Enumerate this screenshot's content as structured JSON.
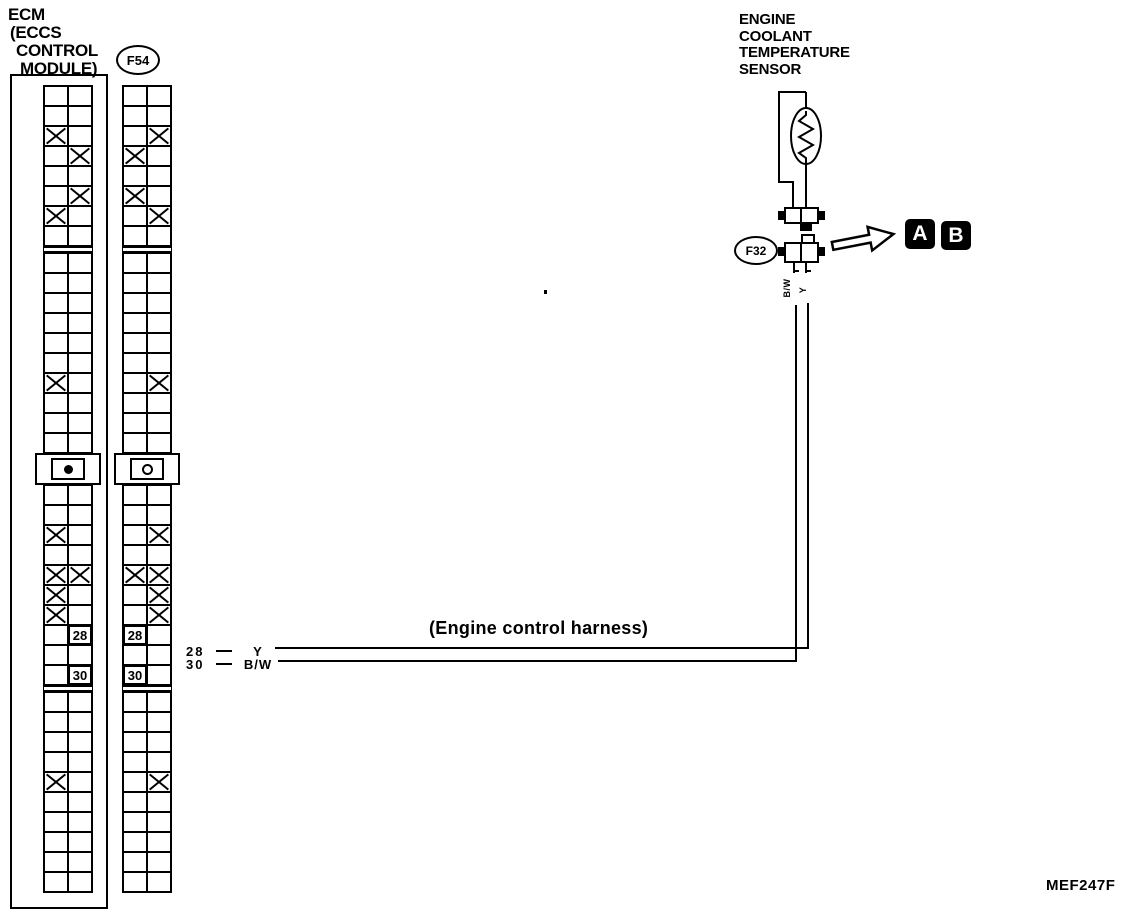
{
  "figure": {
    "code": "MEF247F"
  },
  "harness_note": "(Engine control harness)",
  "ecm": {
    "title_lines": [
      "ECM",
      "(ECCS",
      "CONTROL",
      "MODULE)"
    ]
  },
  "sensor": {
    "title_lines": [
      "ENGINE",
      "COOLANT",
      "TEMPERATURE",
      "SENSOR"
    ]
  },
  "connector_labels": {
    "f54": "F54",
    "f32": "F32"
  },
  "callouts": {
    "a": "A",
    "b": "B"
  },
  "wires": [
    {
      "pin": "28",
      "color": "Y"
    },
    {
      "pin": "30",
      "color": "B/W"
    }
  ],
  "connector_pin_labels": {
    "left": "B/W",
    "right": "Y"
  },
  "ecm_grid": {
    "bolt": "filled",
    "rows": [
      [
        "",
        ""
      ],
      [
        "",
        ""
      ],
      [
        "x",
        ""
      ],
      [
        "",
        "x"
      ],
      [
        "",
        ""
      ],
      [
        "",
        "x"
      ],
      [
        "x",
        ""
      ],
      [
        "",
        ""
      ],
      "sep",
      [
        "",
        ""
      ],
      [
        "",
        ""
      ],
      [
        "",
        ""
      ],
      [
        "",
        ""
      ],
      [
        "",
        ""
      ],
      [
        "",
        ""
      ],
      [
        "x",
        ""
      ],
      [
        "",
        ""
      ],
      [
        "",
        ""
      ],
      [
        "",
        ""
      ],
      "dot",
      [
        "",
        ""
      ],
      [
        "",
        ""
      ],
      [
        "x",
        ""
      ],
      [
        "",
        ""
      ],
      [
        "x",
        "x"
      ],
      [
        "x",
        ""
      ],
      [
        "x",
        ""
      ],
      [
        "",
        "28"
      ],
      [
        "",
        ""
      ],
      [
        "",
        "30"
      ],
      "sep",
      [
        "",
        ""
      ],
      [
        "",
        ""
      ],
      [
        "",
        ""
      ],
      [
        "",
        ""
      ],
      [
        "x",
        ""
      ],
      [
        "",
        ""
      ],
      [
        "",
        ""
      ],
      [
        "",
        ""
      ],
      [
        "",
        ""
      ],
      [
        "",
        ""
      ]
    ]
  },
  "f54_grid": {
    "bolt": "hollow",
    "rows": [
      [
        "",
        ""
      ],
      [
        "",
        ""
      ],
      [
        "",
        "x"
      ],
      [
        "x",
        ""
      ],
      [
        "",
        ""
      ],
      [
        "x",
        ""
      ],
      [
        "",
        "x"
      ],
      [
        "",
        ""
      ],
      "sep",
      [
        "",
        ""
      ],
      [
        "",
        ""
      ],
      [
        "",
        ""
      ],
      [
        "",
        ""
      ],
      [
        "",
        ""
      ],
      [
        "",
        ""
      ],
      [
        "",
        "x"
      ],
      [
        "",
        ""
      ],
      [
        "",
        ""
      ],
      [
        "",
        ""
      ],
      "dot",
      [
        "",
        ""
      ],
      [
        "",
        ""
      ],
      [
        "",
        "x"
      ],
      [
        "",
        ""
      ],
      [
        "x",
        "x"
      ],
      [
        "",
        "x"
      ],
      [
        "",
        "x"
      ],
      [
        "28",
        ""
      ],
      [
        "",
        ""
      ],
      [
        "30",
        ""
      ],
      "sep",
      [
        "",
        ""
      ],
      [
        "",
        ""
      ],
      [
        "",
        ""
      ],
      [
        "",
        ""
      ],
      [
        "",
        "x"
      ],
      [
        "",
        ""
      ],
      [
        "",
        ""
      ],
      [
        "",
        ""
      ],
      [
        "",
        ""
      ],
      [
        "",
        ""
      ]
    ]
  }
}
